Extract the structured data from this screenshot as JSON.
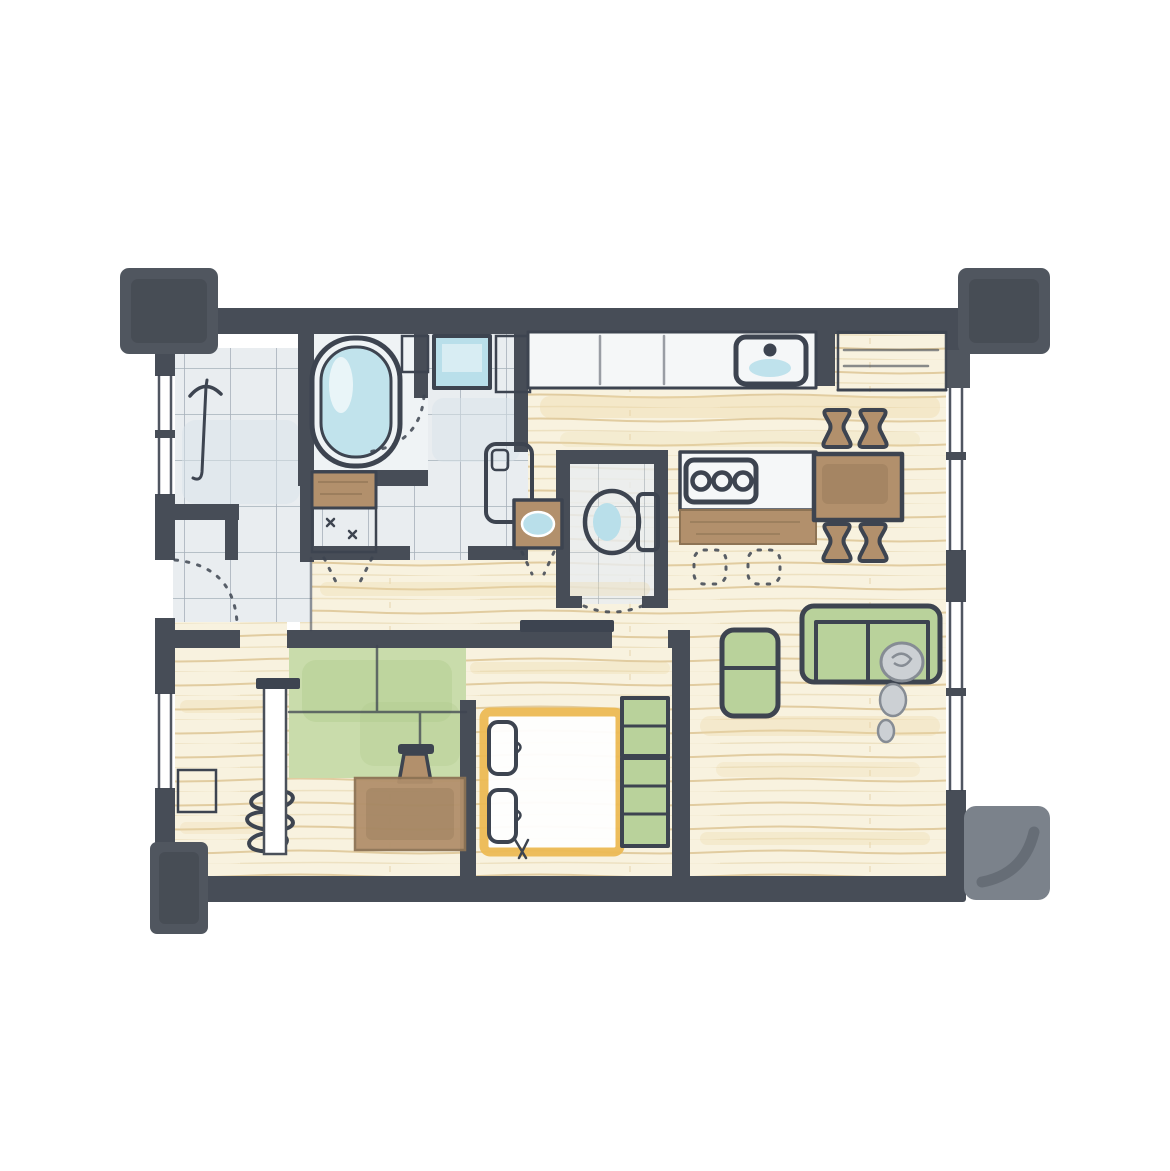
{
  "illustration": {
    "kind": "apartment-floor-plan",
    "style": "hand-drawn-watercolor",
    "rooms": [
      "entry",
      "bathroom",
      "washroom",
      "toilet",
      "hallway",
      "kitchen",
      "dining-area",
      "living-area",
      "bedroom",
      "tatami-room",
      "walk-in-closet"
    ],
    "fixtures": [
      "bathtub",
      "bathroom-window",
      "washing-machine",
      "washbasin-vanity",
      "hand-basin",
      "toilet-bowl",
      "kitchen-sink",
      "gas-stove",
      "kitchen-island",
      "refrigerator-nook",
      "dining-table",
      "dining-chairs",
      "sofa",
      "armchair",
      "tv-board",
      "low-chest",
      "flower-vase",
      "hanger-rack",
      "folded-futon-stack",
      "shelf-stack",
      "nightstand",
      "umbrella",
      "sliding-partition"
    ],
    "features": [
      "entrance-door-swing",
      "bathroom-door-swing",
      "toilet-door-swing",
      "corner-pillars",
      "window-strips",
      "bar-stool-outlines"
    ]
  },
  "colors": {
    "background": "#ffffff",
    "wall": "#474d57",
    "pillar": "#50565f",
    "pillar_light": "#7b828b",
    "outline": "#3d4450",
    "wood_floor": "#f8f2df",
    "wood_line": "#d9bf8a",
    "wood_wash": "#ecd8a6",
    "tile_floor": "#e9edf0",
    "tile_line": "#9aa6b0",
    "tile_wash": "#d9e4ea",
    "bath_floor": "#eff3f5",
    "tatami_green": "#c9dcab",
    "tatami_wash": "#aecb8a",
    "upholstery_green": "#b9d29b",
    "furniture_brown": "#b2906c",
    "furniture_brown_dark": "#8d7354",
    "water_blue": "#b9dfea",
    "closet_accent": "#edbb55",
    "counter_white": "#f5f7f8",
    "figure_gray": "#ccd0d4"
  }
}
